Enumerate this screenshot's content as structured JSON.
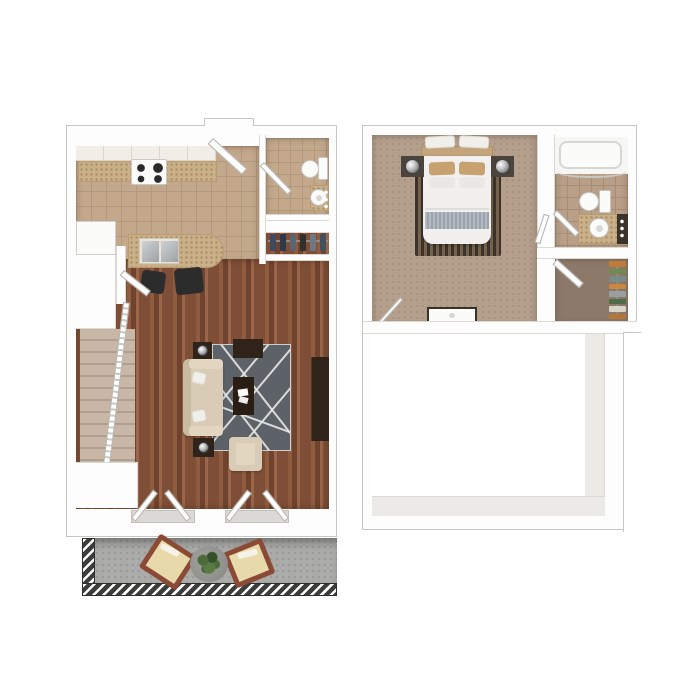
{
  "palette": {
    "wall": "#fdfdfd",
    "wall-line": "#c6c6c3",
    "hairline": "#dcd8d2",
    "door-line": "#b2b2ae",
    "tile": "#c3a88c",
    "tile-line": "#b2987c",
    "tile-bath": "#b99f88",
    "tile-bath-line": "#a78d76",
    "wood-a": "#7f4e36",
    "wood-b": "#8f5c40",
    "wood-c": "#6f432d",
    "wood-d": "#9a6548",
    "granite": "#c9b089",
    "granite-dot": "#ab8e63",
    "carpet-stairs": "#c8b7a7",
    "carpet-stairs-line": "#b09f8f",
    "carpet-stairs2": "#c0afa0",
    "carpet-stairs2-line": "#a8978a",
    "carpet-bed": "#b49e8c",
    "carpet-bed-dot": "#a8927e",
    "carpet-closet": "#8d796a",
    "void-face": "#eceae6",
    "rug": "#5d6268",
    "rug-line": "#e8e8e6",
    "sofa": "#d9ccb6",
    "sofa-shade": "#c9bba2",
    "sofa-arm": "#e2d6c1",
    "dark-wood": "#2f231a",
    "rail-dark": "#3c3c3a",
    "concrete": "#ababa9",
    "concrete-dot": "#9a9a98",
    "bed-white": "#f1f0ee",
    "bed-band": "#9ba3ae",
    "pillow-tan": "#c8a171",
    "headboard": "#c3a47c",
    "bed-rug-a": "#3b332a",
    "bed-rug-b": "#75634e",
    "steel": "#b9bcbe",
    "chair-frame": "#8a4a35",
    "cushion": "#e8d9ab",
    "planter": "#8e8e8a",
    "plant": "#4c6b3a",
    "plant-dark": "#36512a"
  },
  "closet1_colors": [
    "#3f4a5e",
    "#2e3848",
    "#5a6472",
    "#31302e",
    "#6e7884",
    "#454f5c"
  ],
  "closet2_colors": [
    "#c07a3a",
    "#708a50",
    "#7a8a84",
    "#c9873f",
    "#9aa0a2",
    "#4f6b4a",
    "#d8d4c8",
    "#b5763a"
  ],
  "floors": [
    {
      "label": "First Floor",
      "rooms": [
        "Kitchen",
        "Powder Room",
        "Coat Closet",
        "Living Room",
        "Stairs",
        "Balcony"
      ],
      "fixtures": [
        "range",
        "refrigerator",
        "island double sink",
        "bar stools",
        "toilet",
        "pedestal sink",
        "hanging coats",
        "entry door",
        "sofa",
        "coffee table",
        "tv bench",
        "end tables with lamps",
        "armchair",
        "media console",
        "area rug",
        "french patio doors",
        "outdoor chairs",
        "planter with plant",
        "balcony railing"
      ]
    },
    {
      "label": "Second Floor",
      "rooms": [
        "Bedroom",
        "Bathroom",
        "Walk-in Closet",
        "Stairs",
        "Open to Below"
      ],
      "fixtures": [
        "bed with headboard",
        "nightstands with lamps",
        "bed rug",
        "dresser",
        "bathtub with shower curtain",
        "toilet",
        "vanity sink with mirror lights",
        "hanging clothes",
        "staircase",
        "railing"
      ]
    }
  ]
}
